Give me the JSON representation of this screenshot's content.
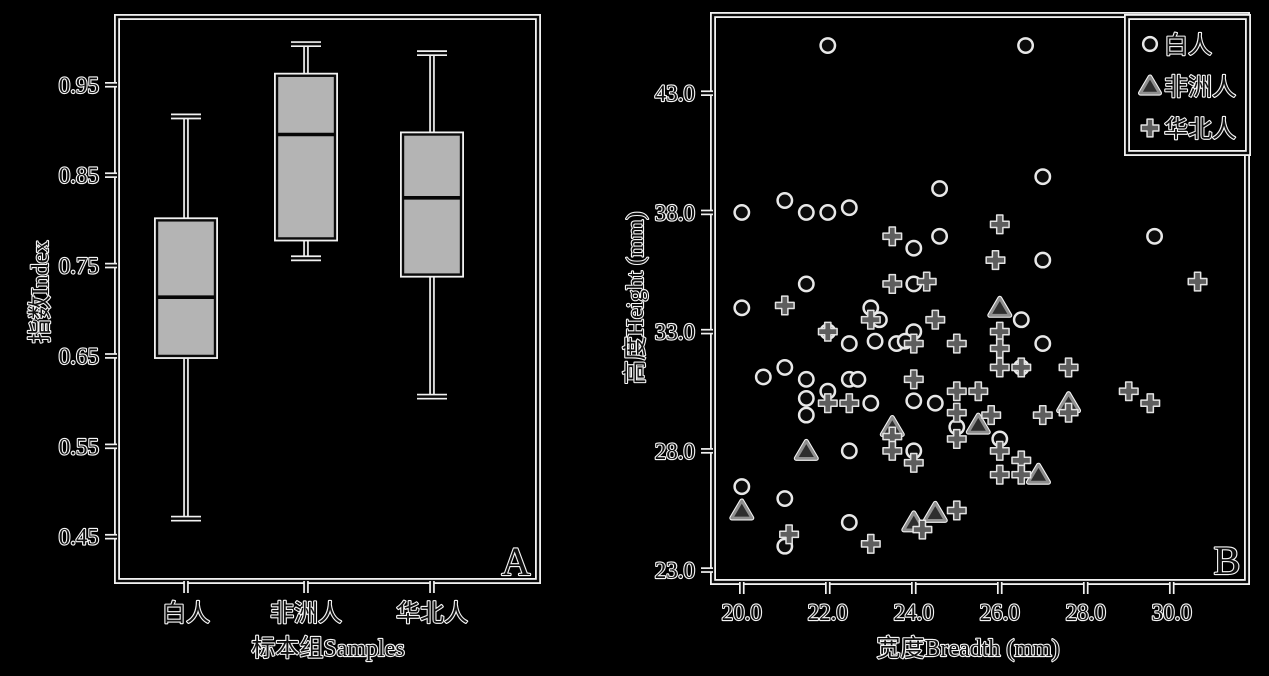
{
  "figure": {
    "background": "#000000"
  },
  "colors": {
    "background": "#000000",
    "halo": "#f2f2f2",
    "ink": "#0a0a0a",
    "box_fill": "#b4b4b4",
    "plus_gray": "#5e5e5e",
    "triangle_fill": "#2e2e2e",
    "triangle_edge": "#8f8f8f",
    "circle_fill": "#0b0b0b",
    "circle_edge": "#e8e8e8"
  },
  "chart_data": [
    {
      "type": "box",
      "panel_label": "A",
      "xlabel": "标本组Samples",
      "ylabel": "指数Index",
      "categories": [
        "白人",
        "非洲人",
        "华北人"
      ],
      "ylim": [
        0.401,
        1.025
      ],
      "ytick_values": [
        0.45,
        0.55,
        0.65,
        0.75,
        0.85,
        0.95
      ],
      "ytick_labels": [
        "0.45",
        "0.55",
        "0.65",
        "0.75",
        "0.85",
        "0.95"
      ],
      "grid": false,
      "boxes": [
        {
          "category": "白人",
          "low": 0.47,
          "q1": 0.65,
          "median": 0.715,
          "q3": 0.8,
          "high": 0.915
        },
        {
          "category": "非洲人",
          "low": 0.758,
          "q1": 0.78,
          "median": 0.895,
          "q3": 0.96,
          "high": 0.995
        },
        {
          "category": "华北人",
          "low": 0.605,
          "q1": 0.74,
          "median": 0.825,
          "q3": 0.895,
          "high": 0.985
        }
      ]
    },
    {
      "type": "scatter",
      "panel_label": "B",
      "xlabel": "宽度Breadth (mm)",
      "ylabel": "高度Height (mm)",
      "xlim": [
        19.33,
        31.75
      ],
      "ylim": [
        22.5,
        46.28
      ],
      "xtick_values": [
        20,
        22,
        24,
        26,
        28,
        30
      ],
      "xtick_labels": [
        "20.0",
        "22.0",
        "24.0",
        "26.0",
        "28.0",
        "30.0"
      ],
      "ytick_values": [
        23,
        28,
        33,
        38,
        43
      ],
      "ytick_labels": [
        "23.0",
        "28.0",
        "33.0",
        "38.0",
        "43.0"
      ],
      "grid": false,
      "legend_position": "top-right",
      "series": [
        {
          "name": "白人",
          "marker": "circle",
          "points": [
            [
              22.0,
              45.0
            ],
            [
              26.6,
              45.0
            ],
            [
              20.0,
              38.0
            ],
            [
              21.0,
              38.5
            ],
            [
              21.5,
              38.0
            ],
            [
              22.0,
              38.0
            ],
            [
              22.5,
              38.2
            ],
            [
              24.6,
              39.0
            ],
            [
              27.0,
              39.5
            ],
            [
              24.0,
              36.5
            ],
            [
              24.6,
              37.0
            ],
            [
              27.0,
              36.0
            ],
            [
              29.6,
              37.0
            ],
            [
              21.5,
              35.0
            ],
            [
              24.0,
              35.0
            ],
            [
              20.0,
              34.0
            ],
            [
              23.0,
              34.0
            ],
            [
              26.5,
              33.5
            ],
            [
              24.0,
              33.0
            ],
            [
              23.2,
              33.5
            ],
            [
              27.0,
              32.5
            ],
            [
              22.5,
              32.5
            ],
            [
              23.1,
              32.6
            ],
            [
              23.6,
              32.5
            ],
            [
              23.8,
              32.6
            ],
            [
              20.5,
              31.1
            ],
            [
              21.0,
              31.5
            ],
            [
              21.5,
              31.0
            ],
            [
              22.5,
              31.0
            ],
            [
              22.7,
              31.0
            ],
            [
              26.5,
              31.5
            ],
            [
              21.5,
              30.2
            ],
            [
              22.0,
              30.5
            ],
            [
              23.0,
              30.0
            ],
            [
              24.0,
              30.1
            ],
            [
              24.5,
              30.0
            ],
            [
              21.5,
              29.5
            ],
            [
              25.0,
              29.0
            ],
            [
              22.5,
              28.0
            ],
            [
              24.0,
              28.0
            ],
            [
              26.0,
              28.5
            ],
            [
              20.0,
              26.5
            ],
            [
              21.0,
              26.0
            ],
            [
              22.5,
              25.0
            ],
            [
              21.0,
              24.0
            ],
            [
              22.0,
              33.0
            ]
          ]
        },
        {
          "name": "非洲人",
          "marker": "triangle",
          "points": [
            [
              26.0,
              34.0
            ],
            [
              23.5,
              29.0
            ],
            [
              21.5,
              28.0
            ],
            [
              25.5,
              29.1
            ],
            [
              27.6,
              30.0
            ],
            [
              26.9,
              27.0
            ],
            [
              20.0,
              25.5
            ],
            [
              24.0,
              25.0
            ],
            [
              24.5,
              25.4
            ]
          ]
        },
        {
          "name": "华北人",
          "marker": "plus",
          "points": [
            [
              23.5,
              37.0
            ],
            [
              26.0,
              37.5
            ],
            [
              25.9,
              36.0
            ],
            [
              23.5,
              35.0
            ],
            [
              24.3,
              35.1
            ],
            [
              30.6,
              35.1
            ],
            [
              21.0,
              34.1
            ],
            [
              23.0,
              33.5
            ],
            [
              24.5,
              33.5
            ],
            [
              26.0,
              33.0
            ],
            [
              22.0,
              33.0
            ],
            [
              24.0,
              32.5
            ],
            [
              25.0,
              32.5
            ],
            [
              26.0,
              32.3
            ],
            [
              26.0,
              31.5
            ],
            [
              26.5,
              31.5
            ],
            [
              27.6,
              31.5
            ],
            [
              24.0,
              31.0
            ],
            [
              22.0,
              30.0
            ],
            [
              22.5,
              30.0
            ],
            [
              25.5,
              30.5
            ],
            [
              29.0,
              30.5
            ],
            [
              29.5,
              30.0
            ],
            [
              25.0,
              30.5
            ],
            [
              25.0,
              29.6
            ],
            [
              25.8,
              29.5
            ],
            [
              27.0,
              29.5
            ],
            [
              27.6,
              29.6
            ],
            [
              23.5,
              28.6
            ],
            [
              23.5,
              28.0
            ],
            [
              25.0,
              28.5
            ],
            [
              24.0,
              27.5
            ],
            [
              26.0,
              28.0
            ],
            [
              26.0,
              27.0
            ],
            [
              26.5,
              27.6
            ],
            [
              26.5,
              27.0
            ],
            [
              21.1,
              24.5
            ],
            [
              23.0,
              24.1
            ],
            [
              24.2,
              24.7
            ],
            [
              25.0,
              25.5
            ]
          ]
        }
      ],
      "legend": [
        {
          "label": "白人",
          "marker": "circle"
        },
        {
          "label": "非洲人",
          "marker": "triangle"
        },
        {
          "label": "华北人",
          "marker": "plus"
        }
      ]
    }
  ]
}
